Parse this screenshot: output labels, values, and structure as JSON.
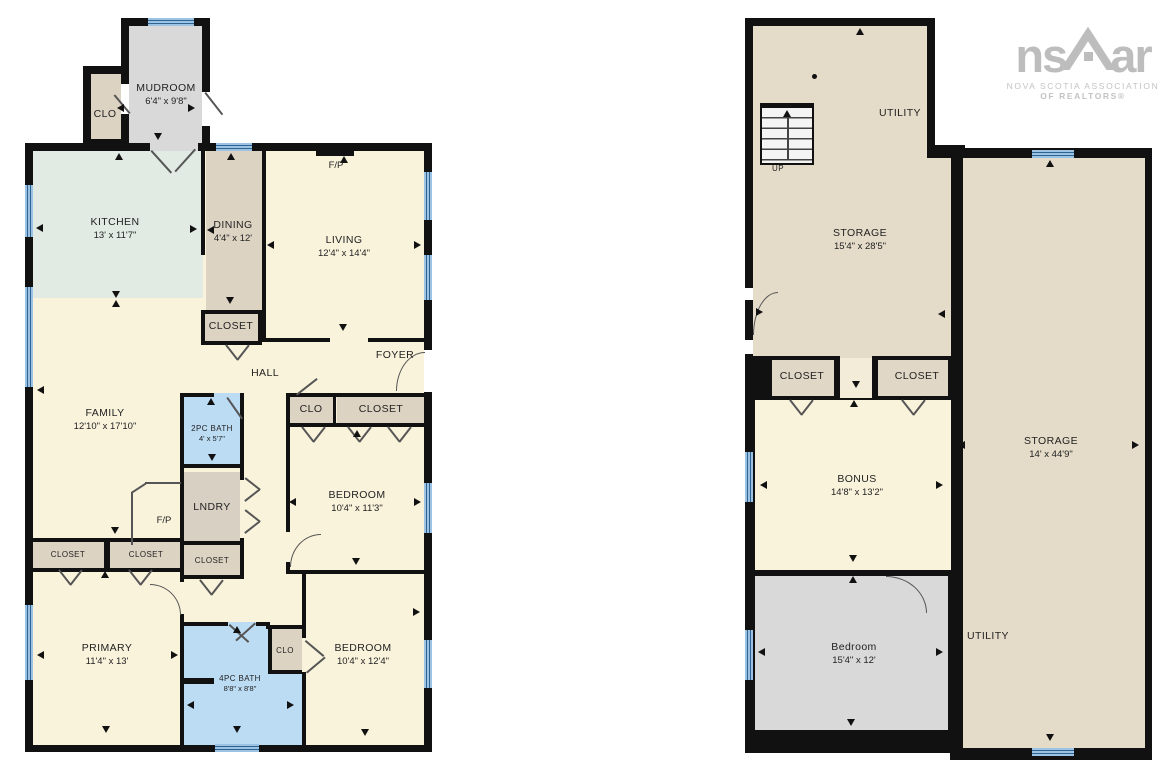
{
  "logo": {
    "text_ns": "ns",
    "text_ar": "ar",
    "line1": "NOVA SCOTIA ASSOCIATION",
    "line2": "OF REALTORS®"
  },
  "colors": {
    "wall": "#111111",
    "floor_cream": "#faf3dc",
    "floor_mint": "#e2ebe3",
    "floor_tan": "#ddd3c3",
    "floor_gray": "#d9d9d9",
    "floor_blue": "#bcdcf4",
    "window_blue": "#9cc3e3",
    "logo_gray": "#bdbdbd"
  },
  "plans": {
    "main": {
      "rooms": {
        "mudroom": {
          "name": "MUDROOM",
          "dims": "6'4\" x 9'8\""
        },
        "clo_mud": {
          "name": "CLO"
        },
        "kitchen": {
          "name": "KITCHEN",
          "dims": "13' x 11'7\""
        },
        "dining": {
          "name": "DINING",
          "dims": "4'4\" x 12'"
        },
        "living": {
          "name": "LIVING",
          "dims": "12'4\" x 14'4\""
        },
        "fp_living": {
          "name": "F/P"
        },
        "closet_dining": {
          "name": "CLOSET"
        },
        "foyer": {
          "name": "FOYER"
        },
        "hall": {
          "name": "HALL"
        },
        "family": {
          "name": "FAMILY",
          "dims": "12'10\" x 17'10\""
        },
        "bath2": {
          "name": "2PC BATH",
          "dims": "4' x 5'7\""
        },
        "lndry": {
          "name": "LNDRY"
        },
        "closet_lndry": {
          "name": "CLOSET"
        },
        "clo_hall": {
          "name": "CLO"
        },
        "closet_bed1": {
          "name": "CLOSET"
        },
        "bedroom1": {
          "name": "BEDROOM",
          "dims": "10'4\" x 11'3\""
        },
        "fp_family": {
          "name": "F/P"
        },
        "closet_p1": {
          "name": "CLOSET"
        },
        "closet_p2": {
          "name": "CLOSET"
        },
        "primary": {
          "name": "PRIMARY",
          "dims": "11'4\" x 13'"
        },
        "bath4": {
          "name": "4PC BATH",
          "dims": "8'8\" x 8'8\""
        },
        "clo_bed2": {
          "name": "CLO"
        },
        "bedroom2": {
          "name": "BEDROOM",
          "dims": "10'4\" x 12'4\""
        }
      }
    },
    "basement": {
      "rooms": {
        "utility_top": {
          "name": "UTILITY"
        },
        "up": {
          "name": "UP"
        },
        "storage1": {
          "name": "STORAGE",
          "dims": "15'4\" x 28'5\""
        },
        "closet_l": {
          "name": "CLOSET"
        },
        "closet_r": {
          "name": "CLOSET"
        },
        "bonus": {
          "name": "BONUS",
          "dims": "14'8\" x 13'2\""
        },
        "bedroom": {
          "name": "Bedroom",
          "dims": "15'4\" x 12'"
        },
        "storage2": {
          "name": "STORAGE",
          "dims": "14' x 44'9\""
        },
        "utility_b": {
          "name": "UTILITY"
        }
      }
    }
  }
}
